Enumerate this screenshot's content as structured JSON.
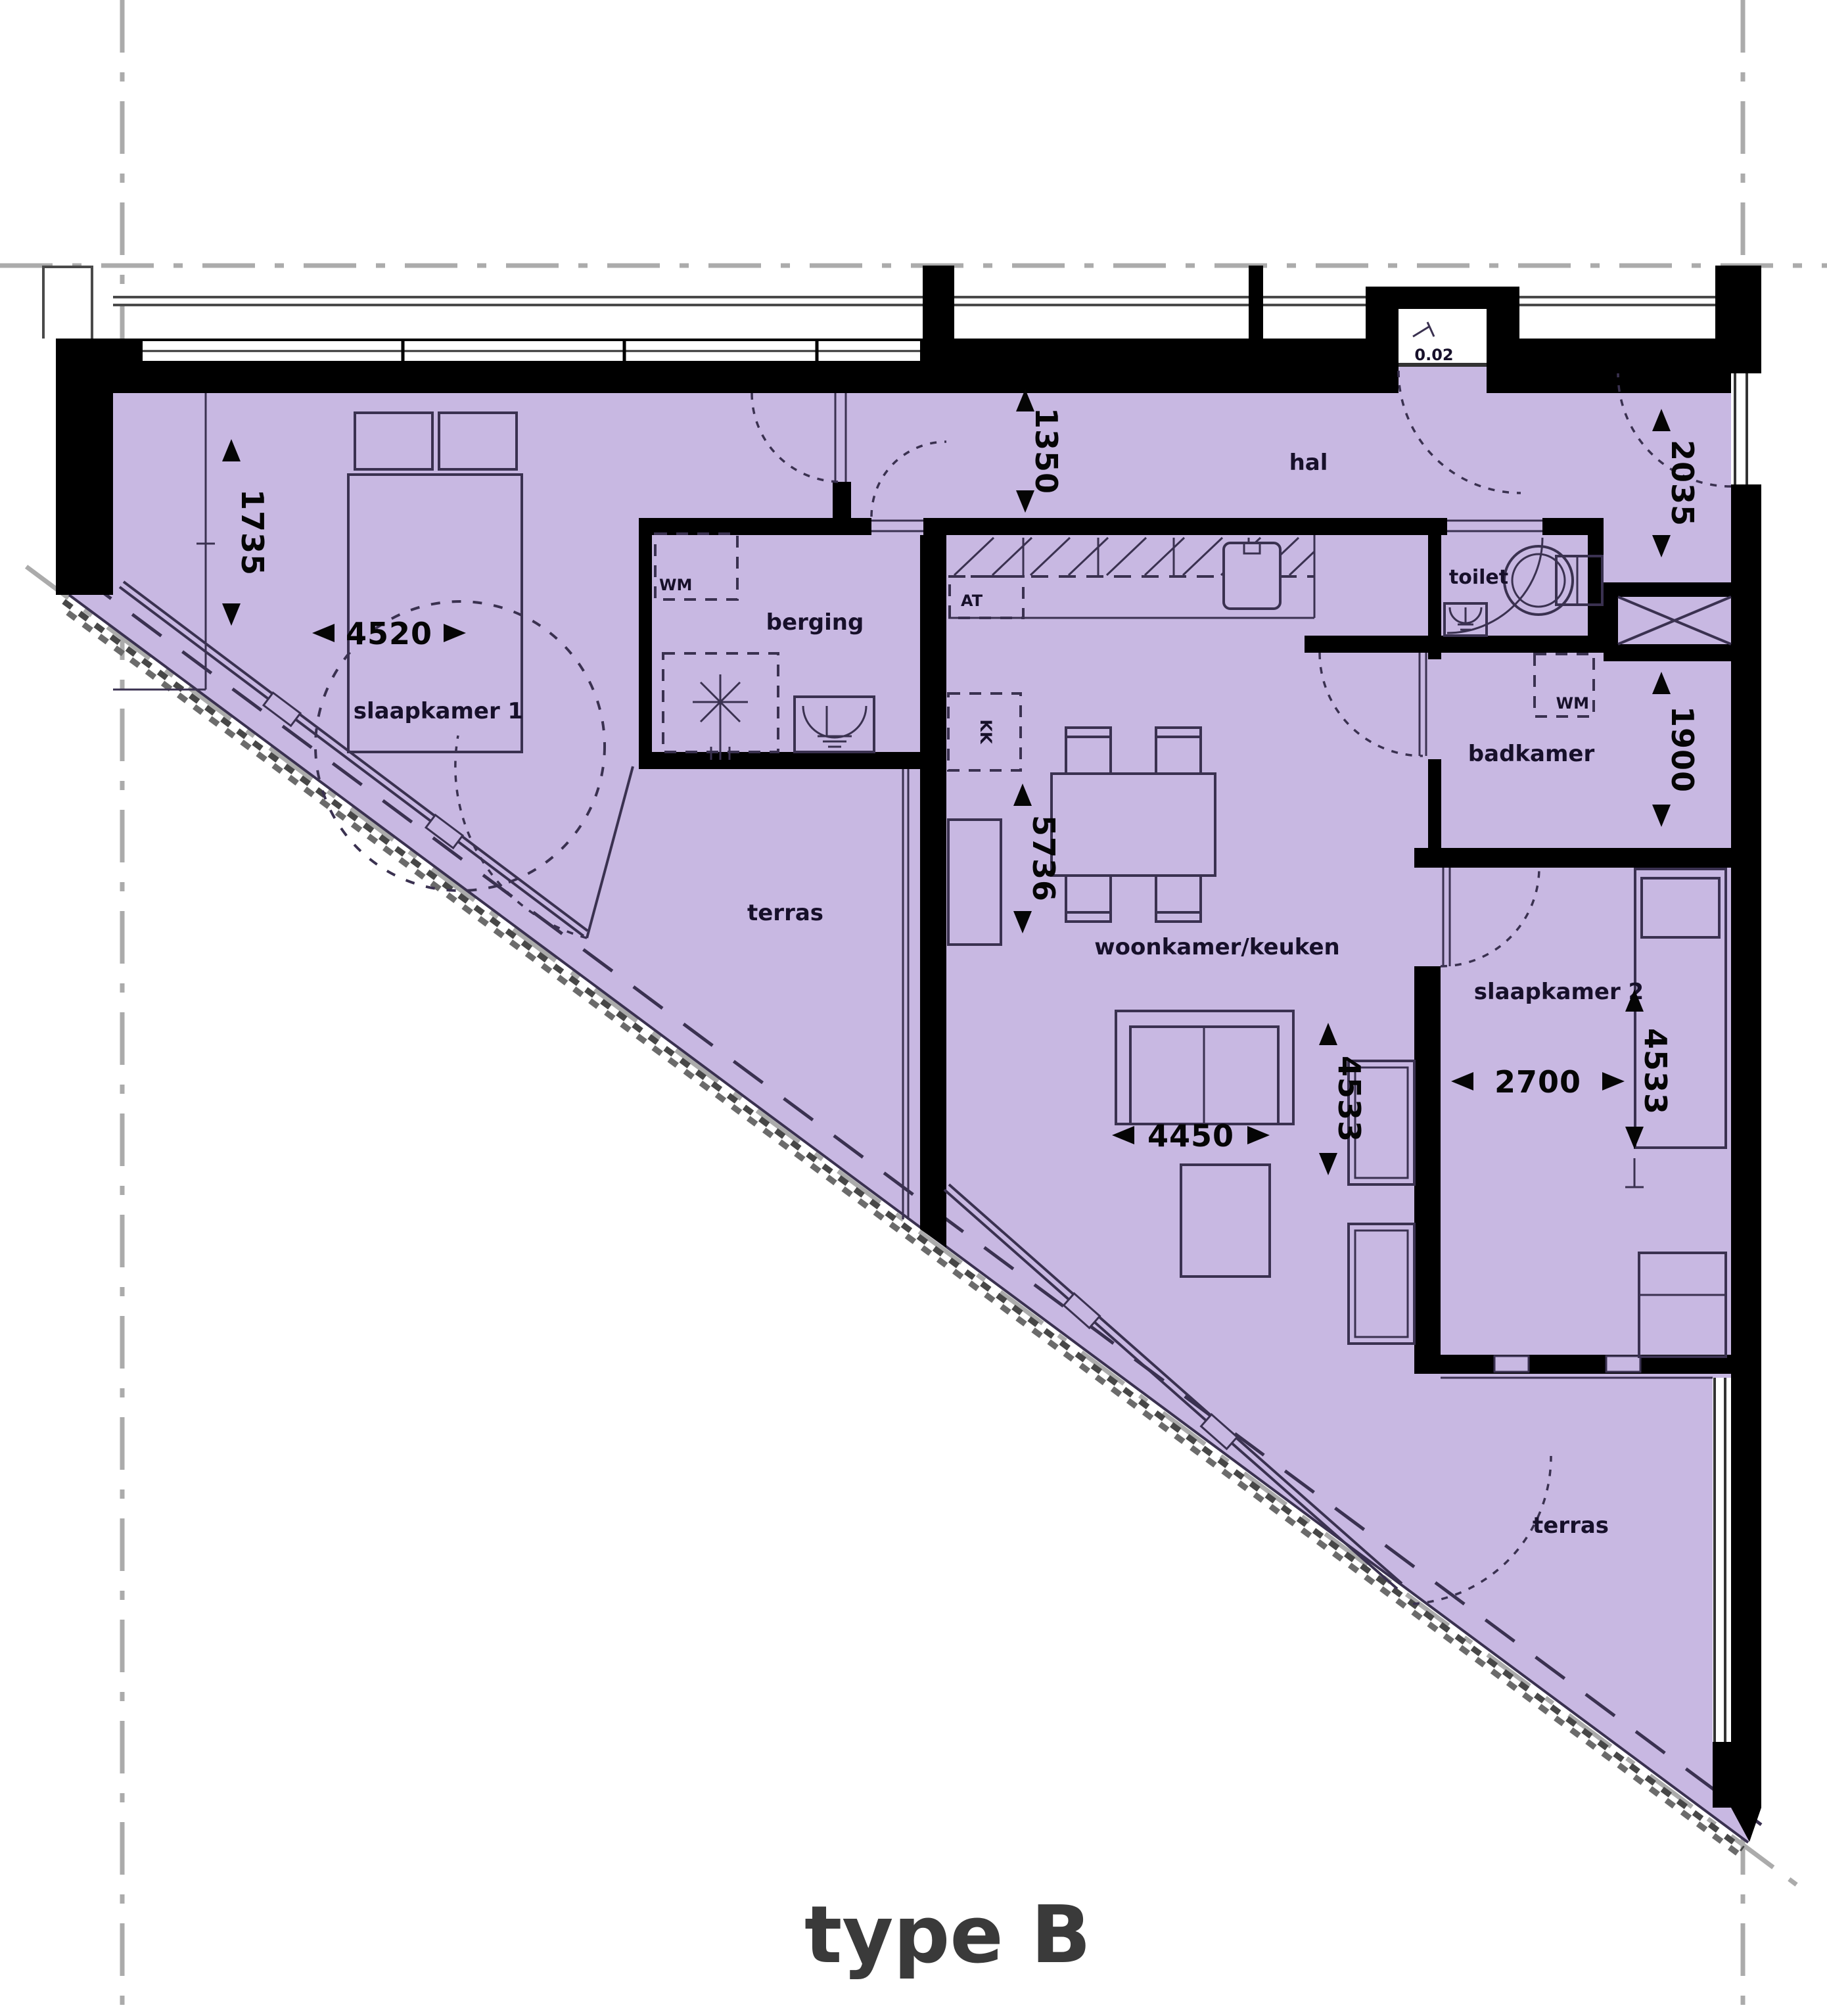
{
  "plan": {
    "type_label": "type B",
    "rooms": {
      "slaapkamer1": "slaapkamer 1",
      "berging": "berging",
      "hal": "hal",
      "toilet": "toilet",
      "badkamer": "badkamer",
      "woonkamer": "woonkamer/keuken",
      "slaapkamer2": "slaapkamer 2",
      "terras_west": "terras",
      "terras_zuid": "terras"
    },
    "dimensions_mm": {
      "slaapkamer1_kastzone": "1735",
      "slaapkamer1_breedte": "4520",
      "hal_breedte": "1350",
      "hal_hoogte": "2035",
      "woonkamer_diepte": "5736",
      "badkamer_hoogte": "1900",
      "woonkamer_breedte": "4450",
      "woonkamer_hoogte": "4533",
      "slaapkamer2_breedte": "2700",
      "slaapkamer2_hoogte": "4533"
    },
    "fixtures": {
      "wasmachine_berging": "WM",
      "wasmachine_badkamer": "WM",
      "aanrecht": "AT",
      "koelkast": "KK",
      "entree_nummer": "0.02"
    },
    "colors": {
      "floor": "#c8b8e2",
      "wall": "#000000",
      "line": "#3a3150",
      "grid": "#ababab"
    }
  }
}
